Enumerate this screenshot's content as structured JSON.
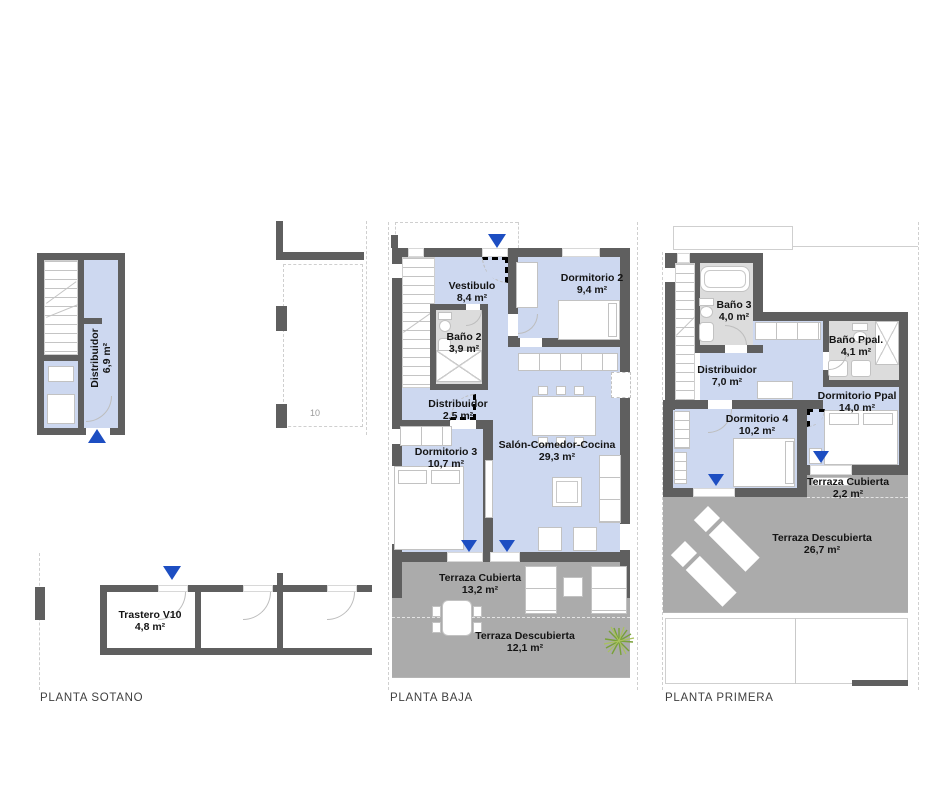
{
  "colors": {
    "wall": "#5f5f5f",
    "room_fill": "#cdd8f0",
    "terrace": "#ababab",
    "bath_floor": "#dcdcdc",
    "arrow": "#1d4ec2"
  },
  "plans": {
    "sotano": {
      "title": "PLANTA SOTANO",
      "neighbor_label": "10",
      "rooms": {
        "distribuidor": {
          "name": "Distribuidor",
          "area": "6,9 m²"
        },
        "trastero": {
          "name": "Trastero V10",
          "area": "4,8 m²"
        }
      }
    },
    "baja": {
      "title": "PLANTA BAJA",
      "rooms": {
        "vestibulo": {
          "name": "Vestibulo",
          "area": "8,4 m²"
        },
        "dormitorio2": {
          "name": "Dormitorio 2",
          "area": "9,4 m²"
        },
        "bano2": {
          "name": "Baño 2",
          "area": "3,9 m²"
        },
        "distribuidor": {
          "name": "Distribuidor",
          "area": "2,5 m²"
        },
        "dormitorio3": {
          "name": "Dormitorio 3",
          "area": "10,7 m²"
        },
        "salon": {
          "name": "Salón-Comedor-Cocina",
          "area": "29,3 m²"
        },
        "terraza_cubierta": {
          "name": "Terraza Cubierta",
          "area": "13,2 m²"
        },
        "terraza_descubierta": {
          "name": "Terraza Descubierta",
          "area": "12,1 m²"
        }
      }
    },
    "primera": {
      "title": "PLANTA PRIMERA",
      "rooms": {
        "bano3": {
          "name": "Baño 3",
          "area": "4,0 m²"
        },
        "distribuidor": {
          "name": "Distribuidor",
          "area": "7,0 m²"
        },
        "bano_ppal": {
          "name": "Baño Ppal.",
          "area": "4,1 m²"
        },
        "dormitorio_ppal": {
          "name": "Dormitorio Ppal",
          "area": "14,0 m²"
        },
        "dormitorio4": {
          "name": "Dormitorio 4",
          "area": "10,2 m²"
        },
        "terraza_cubierta": {
          "name": "Terraza Cubierta",
          "area": "2,2 m²"
        },
        "terraza_descubierta": {
          "name": "Terraza Descubierta",
          "area": "26,7 m²"
        }
      }
    }
  }
}
